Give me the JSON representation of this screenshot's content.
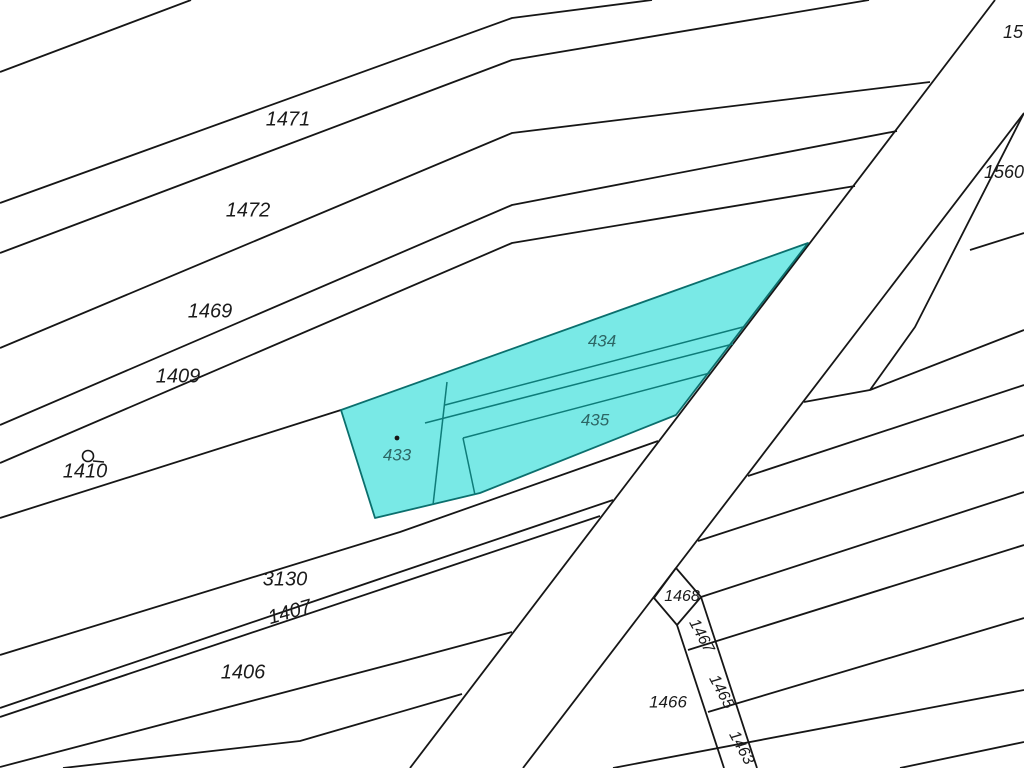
{
  "map": {
    "title": "cadastral-parcel-map",
    "canvas": {
      "width": 1024,
      "height": 768
    },
    "colors": {
      "background": "#ffffff",
      "boundary_line": "#161616",
      "highlight_fill": "#79e9e6",
      "highlight_stroke": "#0b6f6d",
      "highlight_inner_line": "#0e7c79",
      "label_color": "#1b1b1b",
      "highlight_label_color": "#2d6665"
    },
    "boundary_lines": [
      {
        "name": "strip-line-a",
        "points": [
          [
            0,
            72
          ],
          [
            191,
            0
          ]
        ]
      },
      {
        "name": "strip-line-b",
        "points": [
          [
            0,
            203
          ],
          [
            512,
            18
          ],
          [
            652,
            0
          ]
        ]
      },
      {
        "name": "strip-line-c",
        "points": [
          [
            0,
            253
          ],
          [
            512,
            60
          ],
          [
            869,
            0
          ]
        ]
      },
      {
        "name": "strip-line-d",
        "points": [
          [
            0,
            348
          ],
          [
            512,
            133
          ],
          [
            930,
            82
          ]
        ]
      },
      {
        "name": "strip-line-e",
        "points": [
          [
            0,
            425
          ],
          [
            512,
            205
          ],
          [
            897,
            131
          ]
        ]
      },
      {
        "name": "strip-line-f",
        "points": [
          [
            0,
            463
          ],
          [
            512,
            243
          ],
          [
            855,
            186
          ]
        ]
      },
      {
        "name": "strip-line-g",
        "points": [
          [
            0,
            518
          ],
          [
            341,
            410
          ]
        ]
      },
      {
        "name": "strip-line-h",
        "points": [
          [
            0,
            655
          ],
          [
            400,
            532
          ],
          [
            658,
            441
          ]
        ]
      },
      {
        "name": "strip-line-i",
        "points": [
          [
            0,
            708
          ],
          [
            400,
            572
          ],
          [
            613,
            500
          ]
        ]
      },
      {
        "name": "strip-line-j",
        "points": [
          [
            0,
            717
          ],
          [
            400,
            583
          ],
          [
            600,
            516
          ]
        ]
      },
      {
        "name": "strip-line-k",
        "points": [
          [
            0,
            767
          ],
          [
            400,
            662
          ],
          [
            512,
            632
          ]
        ]
      },
      {
        "name": "strip-line-l",
        "points": [
          [
            63,
            768
          ],
          [
            300,
            741
          ],
          [
            462,
            694
          ]
        ]
      },
      {
        "name": "road-left-edge",
        "points": [
          [
            995,
            0
          ],
          [
            410,
            768
          ]
        ]
      },
      {
        "name": "road-right-edge",
        "points": [
          [
            1024,
            113
          ],
          [
            523,
            768
          ]
        ]
      },
      {
        "name": "road-spur-edge",
        "points": [
          [
            1024,
            113
          ],
          [
            915,
            327
          ],
          [
            870,
            390
          ]
        ]
      },
      {
        "name": "right-strip-line-1",
        "points": [
          [
            970,
            250
          ],
          [
            1024,
            233
          ]
        ]
      },
      {
        "name": "right-strip-line-2",
        "points": [
          [
            804,
            402
          ],
          [
            870,
            390
          ],
          [
            1024,
            330
          ]
        ]
      },
      {
        "name": "right-strip-line-3",
        "points": [
          [
            748,
            476
          ],
          [
            1024,
            385
          ]
        ]
      },
      {
        "name": "right-strip-line-4",
        "points": [
          [
            698,
            541
          ],
          [
            1024,
            435
          ]
        ]
      },
      {
        "name": "right-strip-line-5",
        "points": [
          [
            701,
            597
          ],
          [
            1024,
            492
          ]
        ]
      },
      {
        "name": "right-strip-line-6",
        "points": [
          [
            688,
            650
          ],
          [
            1024,
            545
          ]
        ]
      },
      {
        "name": "right-strip-line-7",
        "points": [
          [
            708,
            712
          ],
          [
            1024,
            618
          ]
        ]
      },
      {
        "name": "right-strip-line-8",
        "points": [
          [
            613,
            768
          ],
          [
            1024,
            690
          ]
        ]
      },
      {
        "name": "right-strip-line-9",
        "points": [
          [
            900,
            768
          ],
          [
            1024,
            742
          ]
        ]
      },
      {
        "name": "parcel-1468-outline",
        "points": [
          [
            676,
            568
          ],
          [
            654,
            598
          ],
          [
            677,
            625
          ],
          [
            701,
            597
          ],
          [
            676,
            568
          ]
        ]
      },
      {
        "name": "corridor-left-edge",
        "points": [
          [
            677,
            625
          ],
          [
            724,
            768
          ]
        ]
      },
      {
        "name": "corridor-right-edge",
        "points": [
          [
            701,
            597
          ],
          [
            757,
            768
          ]
        ]
      }
    ],
    "highlight": {
      "outline_points": [
        [
          341,
          410
        ],
        [
          808,
          243
        ],
        [
          676,
          415
        ],
        [
          480,
          493
        ],
        [
          375,
          518
        ]
      ],
      "inner_lines": [
        {
          "name": "divider-433-east",
          "points": [
            [
              447,
              382
            ],
            [
              433,
              505
            ]
          ]
        },
        {
          "name": "divider-434-south",
          "points": [
            [
              445,
              405
            ],
            [
              743,
              327
            ]
          ]
        },
        {
          "name": "divider-435-north",
          "points": [
            [
              425,
              423
            ],
            [
              733,
              344
            ]
          ]
        },
        {
          "name": "divider-435-south",
          "points": [
            [
              463,
              438
            ],
            [
              710,
              373
            ]
          ]
        },
        {
          "name": "divider-435-west",
          "points": [
            [
              463,
              438
            ],
            [
              475,
              495
            ]
          ]
        }
      ]
    },
    "parcel_labels": [
      {
        "id": "1471",
        "text": "1471",
        "x": 288,
        "y": 120,
        "size": 20,
        "rotate": 0,
        "highlighted": false
      },
      {
        "id": "1472",
        "text": "1472",
        "x": 248,
        "y": 211,
        "size": 20,
        "rotate": 0,
        "highlighted": false
      },
      {
        "id": "1469",
        "text": "1469",
        "x": 210,
        "y": 312,
        "size": 20,
        "rotate": 0,
        "highlighted": false
      },
      {
        "id": "1409",
        "text": "1409",
        "x": 178,
        "y": 377,
        "size": 20,
        "rotate": 0,
        "highlighted": false
      },
      {
        "id": "1410",
        "text": "1410",
        "x": 85,
        "y": 472,
        "size": 20,
        "rotate": 0,
        "highlighted": false
      },
      {
        "id": "3130",
        "text": "3130",
        "x": 285,
        "y": 580,
        "size": 20,
        "rotate": 0,
        "highlighted": false
      },
      {
        "id": "1407",
        "text": "1407",
        "x": 290,
        "y": 613,
        "size": 20,
        "rotate": -16,
        "highlighted": false
      },
      {
        "id": "1406",
        "text": "1406",
        "x": 243,
        "y": 673,
        "size": 20,
        "rotate": 0,
        "highlighted": false
      },
      {
        "id": "433",
        "text": "433",
        "x": 397,
        "y": 456,
        "size": 17,
        "rotate": 0,
        "highlighted": true
      },
      {
        "id": "434",
        "text": "434",
        "x": 602,
        "y": 342,
        "size": 17,
        "rotate": 0,
        "highlighted": true
      },
      {
        "id": "435",
        "text": "435",
        "x": 595,
        "y": 421,
        "size": 17,
        "rotate": 0,
        "highlighted": true
      },
      {
        "id": "15",
        "text": "15",
        "x": 1013,
        "y": 33,
        "size": 18,
        "rotate": 0,
        "highlighted": false
      },
      {
        "id": "1560",
        "text": "1560",
        "x": 1004,
        "y": 173,
        "size": 18,
        "rotate": 0,
        "highlighted": false
      },
      {
        "id": "1468",
        "text": "1468",
        "x": 682,
        "y": 597,
        "size": 16,
        "rotate": 0,
        "highlighted": false
      },
      {
        "id": "1467",
        "text": "1467",
        "x": 701,
        "y": 636,
        "size": 16,
        "rotate": 62,
        "highlighted": false
      },
      {
        "id": "1465",
        "text": "1465",
        "x": 721,
        "y": 692,
        "size": 16,
        "rotate": 62,
        "highlighted": false
      },
      {
        "id": "1463",
        "text": "1463",
        "x": 741,
        "y": 748,
        "size": 16,
        "rotate": 62,
        "highlighted": false
      },
      {
        "id": "1466",
        "text": "1466",
        "x": 668,
        "y": 703,
        "size": 17,
        "rotate": 0,
        "highlighted": false
      }
    ],
    "symbols": {
      "landuse_symbol": {
        "name": "circle-landuse-icon",
        "cx": 88,
        "cy": 456,
        "r": 5.5,
        "tail": [
          [
            93,
            461
          ],
          [
            104,
            462
          ]
        ]
      },
      "parcel_433_point": {
        "name": "parcel-point-marker",
        "cx": 397,
        "cy": 438,
        "r": 2.4
      }
    }
  }
}
